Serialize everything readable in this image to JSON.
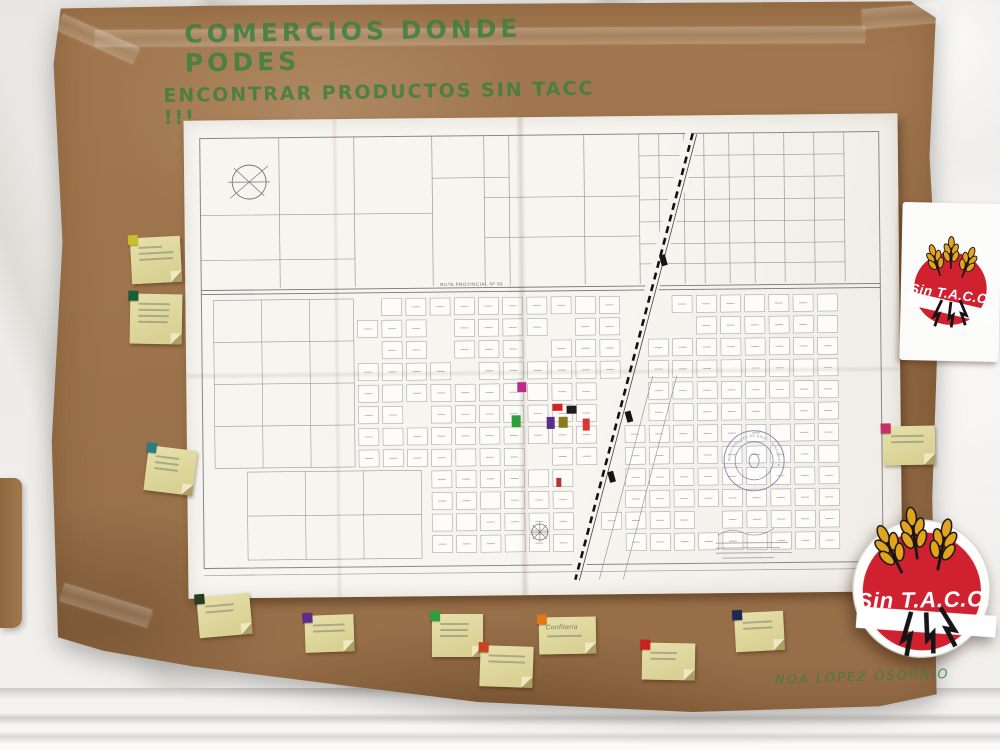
{
  "scene": {
    "title_lines": [
      "COMERCIOS DONDE PODES",
      "ENCONTRAR PRODUCTOS SIN TACC !!!"
    ],
    "title_color": "#3e8040",
    "signature": "NOA LOPEZ OSORNIO",
    "poster_color": "#a87e55",
    "description": "brown kraft poster on white cloth wall with taped town map, sticky notes and gluten-free logos"
  },
  "logo": {
    "label": "Sin T.A.C.C.",
    "red": "#cf2130",
    "wheat_gold": "#e2a41f",
    "stem_black": "#151515"
  },
  "map": {
    "road_label": "RUTA PROVINCIAL Nº 86",
    "stamp_text": "MUNICIPALIDAD DE GRAL. LA MADRID",
    "markers": [
      {
        "color": "#c2278f",
        "x": 331,
        "y": 265,
        "w": 9,
        "h": 10
      },
      {
        "color": "#2e9e3f",
        "x": 325,
        "y": 298,
        "w": 9,
        "h": 12
      },
      {
        "color": "#d42320",
        "x": 366,
        "y": 287,
        "w": 10,
        "h": 7
      },
      {
        "color": "#1d1d1d",
        "x": 380,
        "y": 289,
        "w": 10,
        "h": 8
      },
      {
        "color": "#5d2d8a",
        "x": 360,
        "y": 300,
        "w": 8,
        "h": 12
      },
      {
        "color": "#8a7a1d",
        "x": 372,
        "y": 300,
        "w": 9,
        "h": 11
      },
      {
        "color": "#d83535",
        "x": 396,
        "y": 302,
        "w": 7,
        "h": 12
      },
      {
        "color": "#c03030",
        "x": 369,
        "y": 361,
        "w": 5,
        "h": 9
      }
    ]
  },
  "notes": [
    {
      "x": 131,
      "y": 237,
      "w": 50,
      "h": 46,
      "rot": -3,
      "marker": "#cbbd2a",
      "lines": 3,
      "text": ""
    },
    {
      "x": 130,
      "y": 294,
      "w": 52,
      "h": 50,
      "rot": 1,
      "marker": "#1e5c39",
      "lines": 4,
      "text": ""
    },
    {
      "x": 146,
      "y": 448,
      "w": 49,
      "h": 45,
      "rot": 7,
      "marker": "#2a7d85",
      "lines": 3,
      "text": ""
    },
    {
      "x": 883,
      "y": 426,
      "w": 52,
      "h": 39,
      "rot": -1,
      "marker": "#c52f68",
      "lines": 2,
      "text": ""
    },
    {
      "x": 198,
      "y": 595,
      "w": 53,
      "h": 41,
      "rot": -5,
      "marker": "#233f20",
      "lines": 2,
      "text": ""
    },
    {
      "x": 305,
      "y": 615,
      "w": 49,
      "h": 37,
      "rot": -2,
      "marker": "#5c2c8a",
      "lines": 2,
      "text": ""
    },
    {
      "x": 432,
      "y": 614,
      "w": 51,
      "h": 43,
      "rot": 0,
      "marker": "#2f9e3a",
      "lines": 3,
      "text": ""
    },
    {
      "x": 480,
      "y": 646,
      "w": 53,
      "h": 41,
      "rot": 2,
      "marker": "#c84420",
      "lines": 2,
      "text": ""
    },
    {
      "x": 539,
      "y": 617,
      "w": 57,
      "h": 37,
      "rot": -1,
      "marker": "#e07818",
      "lines": 1,
      "text": "Confiteria"
    },
    {
      "x": 642,
      "y": 643,
      "w": 53,
      "h": 37,
      "rot": 1,
      "marker": "#cc1f1f",
      "lines": 2,
      "text": ""
    },
    {
      "x": 735,
      "y": 612,
      "w": 49,
      "h": 39,
      "rot": -3,
      "marker": "#1d2a52",
      "lines": 2,
      "text": ""
    }
  ]
}
